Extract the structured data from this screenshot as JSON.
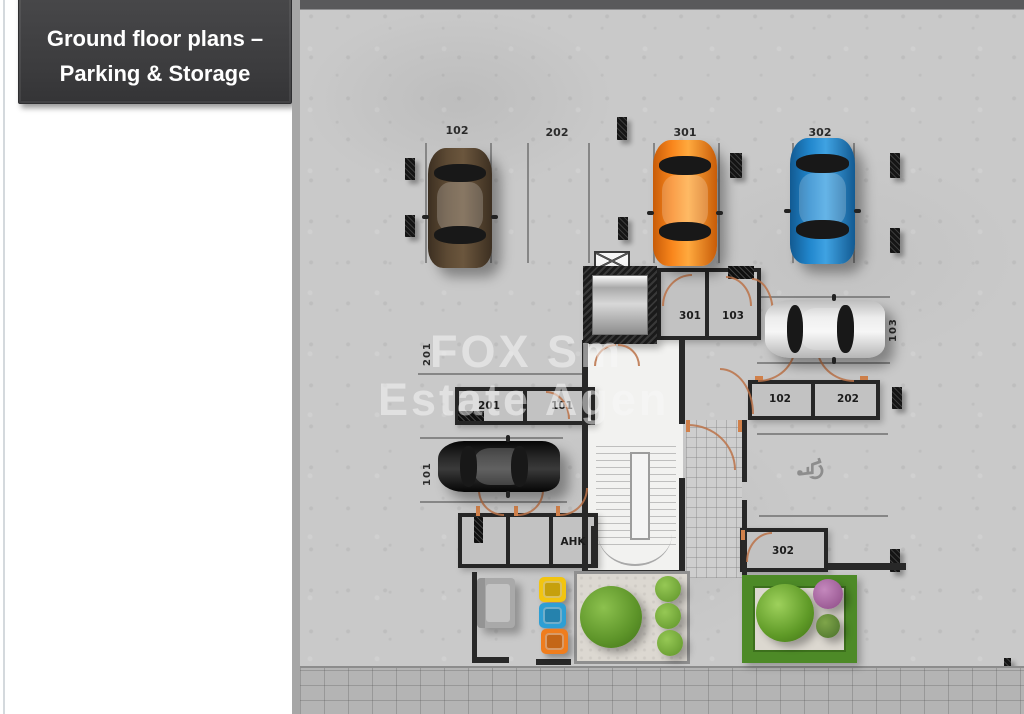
{
  "slide": {
    "title": {
      "line1": "Ground floor plans –",
      "line2": "Parking & Storage"
    }
  },
  "watermark": {
    "line1": "FOX Sm",
    "line2": "Estate Agen"
  },
  "plan": {
    "parking": {
      "top": {
        "s102": "102",
        "s202": "202",
        "s301": "301",
        "s302": "302"
      },
      "side": {
        "s201": "201",
        "s101": "101",
        "s103": "103"
      }
    },
    "storage": {
      "r301": "301",
      "r103": "103",
      "r201": "201",
      "r101": "101",
      "r102": "102",
      "r202": "202",
      "r302": "302",
      "ahk": "AHK"
    },
    "symbols": {
      "wheelchair": "♿"
    },
    "colors": {
      "title_bg": "#3f3f41",
      "concrete": "#c9c9c9",
      "car_brown": "#54422f",
      "car_orange": "#f57c14",
      "car_blue": "#1f7fc4",
      "car_silver": "#e4e4e4",
      "car_black": "#161616",
      "bin_yellow": "#f2c410",
      "bin_blue": "#2e9fd4",
      "bin_orange": "#ef7d1d",
      "tree_green": "#6aa832",
      "hedge_green": "#4d8a27",
      "bush_purple": "#a765a0",
      "door_accent": "#c17347"
    }
  }
}
